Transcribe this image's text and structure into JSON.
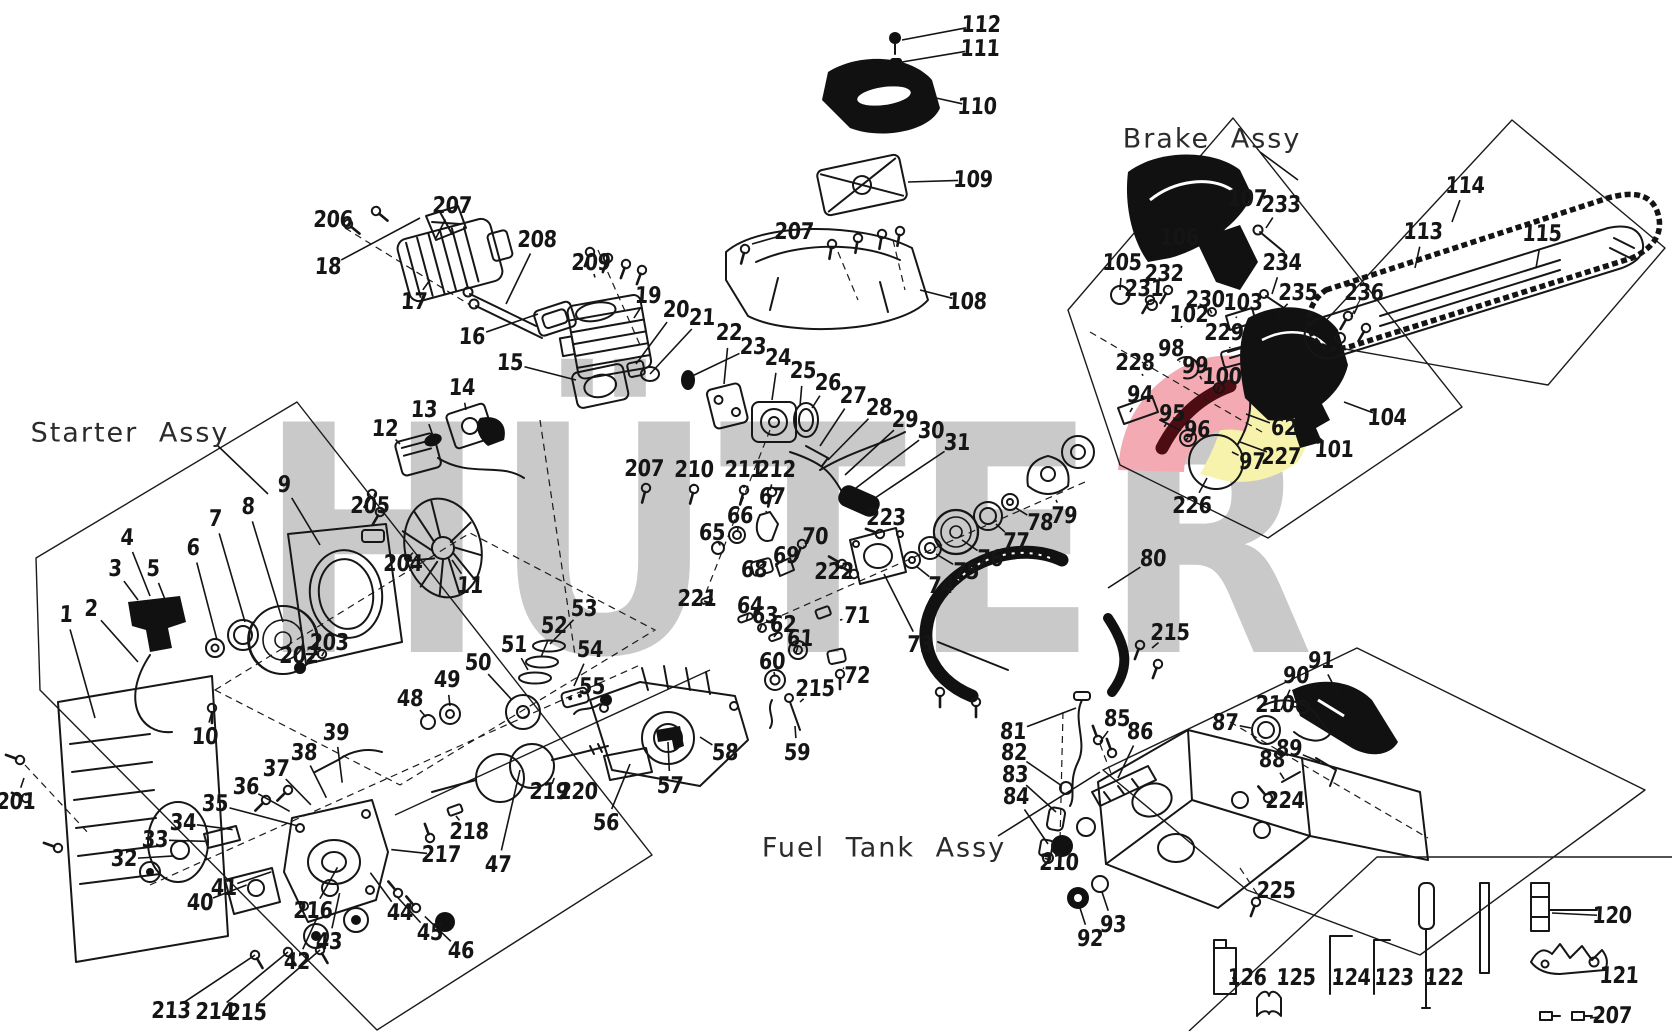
{
  "watermark": {
    "text": "HÜTER",
    "color": "#c9c9c9"
  },
  "highlight": {
    "pink": "#f3aab3",
    "yellow": "#f8f3ac",
    "dark_red": "#4d0b12"
  },
  "titles": [
    {
      "id": "starter",
      "text": "Starter Assy",
      "x": 130,
      "y": 433,
      "line": [
        218,
        446,
        268,
        494
      ]
    },
    {
      "id": "brake",
      "text": "Brake Assy",
      "x": 1212,
      "y": 139,
      "line": [
        1260,
        152,
        1298,
        180
      ]
    },
    {
      "id": "fuel",
      "text": "Fuel Tank Assy",
      "x": 884,
      "y": 848,
      "line": [
        998,
        836,
        1100,
        772
      ]
    }
  ],
  "groups": [
    {
      "name": "starter",
      "anchor": [
        250,
        655
      ],
      "items": [
        [
          "1",
          66,
          615,
          95,
          718
        ],
        [
          "2",
          91,
          609,
          138,
          662
        ],
        [
          "3",
          115,
          569,
          138,
          600
        ],
        [
          "4",
          127,
          538,
          150,
          596
        ],
        [
          "5",
          153,
          569,
          166,
          602
        ],
        [
          "6",
          193,
          548,
          217,
          640
        ],
        [
          "7",
          215,
          519,
          245,
          622
        ],
        [
          "8",
          248,
          507,
          283,
          622
        ],
        [
          "9",
          284,
          485,
          320,
          545
        ],
        [
          "10",
          205,
          737,
          212,
          712
        ],
        [
          "201",
          16,
          802,
          24,
          778
        ],
        [
          "202",
          299,
          656,
          300,
          666
        ],
        [
          "203",
          329,
          643,
          324,
          652
        ]
      ]
    },
    {
      "name": "flywheel",
      "anchor": [
        430,
        545
      ],
      "items": [
        [
          "11",
          470,
          586,
          452,
          560
        ],
        [
          "204",
          403,
          564,
          410,
          556
        ],
        [
          "205",
          370,
          506,
          374,
          496
        ],
        [
          "12",
          385,
          429,
          400,
          444
        ],
        [
          "13",
          424,
          410,
          433,
          436
        ],
        [
          "14",
          462,
          388,
          466,
          410
        ]
      ]
    },
    {
      "name": "muffler",
      "anchor": [
        450,
        262
      ],
      "items": [
        [
          "206",
          333,
          220,
          348,
          224
        ],
        [
          "207",
          452,
          206,
          436,
          238
        ],
        [
          "18",
          328,
          267,
          420,
          218
        ],
        [
          "17",
          414,
          302,
          430,
          280
        ],
        [
          "208",
          537,
          240,
          506,
          304
        ],
        [
          "16",
          472,
          337,
          538,
          314
        ]
      ]
    },
    {
      "name": "cylinder",
      "anchor": [
        608,
        340
      ],
      "items": [
        [
          "209",
          591,
          263,
          594,
          274
        ],
        [
          "19",
          648,
          296,
          634,
          318
        ],
        [
          "20",
          676,
          310,
          636,
          364
        ],
        [
          "21",
          702,
          318,
          650,
          374
        ],
        [
          "22",
          729,
          333,
          724,
          384
        ],
        [
          "23",
          753,
          347,
          688,
          378
        ],
        [
          "15",
          510,
          363,
          576,
          380
        ]
      ]
    },
    {
      "name": "carburetor",
      "anchor": [
        790,
        440
      ],
      "items": [
        [
          "24",
          778,
          358,
          772,
          400
        ],
        [
          "25",
          803,
          371,
          800,
          406
        ],
        [
          "26",
          828,
          383,
          812,
          408
        ],
        [
          "27",
          853,
          396,
          820,
          446
        ],
        [
          "28",
          879,
          408,
          828,
          460
        ],
        [
          "29",
          905,
          420,
          845,
          475
        ],
        [
          "30",
          931,
          431,
          856,
          488
        ],
        [
          "31",
          957,
          443,
          872,
          500
        ],
        [
          "207",
          644,
          469,
          646,
          484
        ],
        [
          "210",
          694,
          470,
          694,
          486
        ],
        [
          "211",
          744,
          470,
          744,
          488
        ],
        [
          "212",
          776,
          470,
          770,
          490
        ]
      ]
    },
    {
      "name": "airbox",
      "anchor": [
        880,
        230
      ],
      "items": [
        [
          "112",
          981,
          25,
          902,
          40
        ],
        [
          "111",
          980,
          49,
          902,
          62
        ],
        [
          "110",
          977,
          107,
          936,
          98
        ],
        [
          "109",
          973,
          180,
          908,
          182
        ],
        [
          "108",
          967,
          302,
          920,
          290
        ],
        [
          "207",
          794,
          232,
          752,
          244
        ]
      ]
    },
    {
      "name": "brake",
      "anchor": [
        1200,
        400
      ],
      "items": [
        [
          "105",
          1122,
          263,
          1120,
          290
        ],
        [
          "106",
          1179,
          238,
          1172,
          256
        ],
        [
          "107",
          1247,
          199,
          1222,
          232
        ],
        [
          "233",
          1281,
          205,
          1266,
          228
        ],
        [
          "231",
          1144,
          289,
          1150,
          300
        ],
        [
          "232",
          1164,
          274,
          1168,
          288
        ],
        [
          "230",
          1205,
          300,
          1210,
          310
        ],
        [
          "102",
          1189,
          315,
          1182,
          326
        ],
        [
          "103",
          1243,
          303,
          1236,
          318
        ],
        [
          "234",
          1282,
          263,
          1272,
          294
        ],
        [
          "235",
          1298,
          293,
          1276,
          316
        ],
        [
          "229",
          1224,
          333,
          1230,
          348
        ],
        [
          "98",
          1171,
          349,
          1180,
          362
        ],
        [
          "99",
          1195,
          366,
          1200,
          376
        ],
        [
          "100",
          1222,
          377,
          1219,
          386
        ],
        [
          "228",
          1135,
          363,
          1142,
          374
        ],
        [
          "94",
          1140,
          395,
          1130,
          412
        ],
        [
          "95",
          1172,
          414,
          1166,
          424
        ],
        [
          "96",
          1197,
          430,
          1188,
          438
        ],
        [
          "97",
          1252,
          462,
          1232,
          452
        ],
        [
          "62",
          1284,
          428,
          1246,
          414
        ],
        [
          "227",
          1281,
          457,
          1240,
          442
        ],
        [
          "101",
          1334,
          450,
          1312,
          432
        ],
        [
          "104",
          1387,
          418,
          1344,
          402
        ],
        [
          "226",
          1192,
          506,
          1207,
          478
        ]
      ]
    },
    {
      "name": "bar-chain",
      "anchor": [
        1480,
        280
      ],
      "items": [
        [
          "113",
          1423,
          232,
          1415,
          268
        ],
        [
          "114",
          1465,
          186,
          1452,
          222
        ],
        [
          "115",
          1542,
          234,
          1536,
          268
        ],
        [
          "236",
          1364,
          293,
          1354,
          314
        ]
      ]
    },
    {
      "name": "clutch",
      "anchor": [
        960,
        530
      ],
      "items": [
        [
          "223",
          886,
          518,
          882,
          530
        ],
        [
          "74",
          941,
          586,
          916,
          566
        ],
        [
          "75",
          966,
          572,
          936,
          554
        ],
        [
          "76",
          990,
          559,
          962,
          540
        ],
        [
          "77",
          1016,
          542,
          996,
          524
        ],
        [
          "78",
          1040,
          523,
          1016,
          508
        ],
        [
          "79",
          1064,
          516,
          1056,
          500
        ],
        [
          "73",
          920,
          645,
          884,
          574
        ],
        [
          "72",
          857,
          676,
          843,
          668
        ],
        [
          "71",
          857,
          616,
          840,
          620
        ],
        [
          "222",
          834,
          572,
          842,
          566
        ]
      ]
    },
    {
      "name": "chain-catcher",
      "anchor": [
        765,
        550
      ],
      "items": [
        [
          "67",
          772,
          497,
          766,
          512
        ],
        [
          "66",
          740,
          516,
          738,
          528
        ],
        [
          "65",
          712,
          533,
          718,
          542
        ],
        [
          "68",
          754,
          570,
          760,
          566
        ],
        [
          "69",
          786,
          556,
          780,
          562
        ],
        [
          "70",
          815,
          537,
          804,
          546
        ]
      ]
    },
    {
      "name": "bearings",
      "anchor": [
        775,
        655
      ],
      "items": [
        [
          "221",
          697,
          599,
          704,
          601
        ],
        [
          "64",
          750,
          606,
          748,
          614
        ],
        [
          "63",
          765,
          616,
          762,
          624
        ],
        [
          "62",
          783,
          625,
          777,
          633
        ],
        [
          "61",
          800,
          639,
          798,
          646
        ],
        [
          "60",
          772,
          662,
          774,
          672
        ],
        [
          "215",
          815,
          689,
          800,
          702
        ]
      ]
    },
    {
      "name": "piston-crank",
      "anchor": [
        520,
        710
      ],
      "items": [
        [
          "53",
          584,
          609,
          550,
          644
        ],
        [
          "52",
          554,
          626,
          541,
          657
        ],
        [
          "51",
          514,
          645,
          528,
          670
        ],
        [
          "50",
          478,
          663,
          512,
          700
        ],
        [
          "49",
          447,
          680,
          450,
          706
        ],
        [
          "48",
          410,
          699,
          426,
          717
        ],
        [
          "54",
          590,
          650,
          574,
          686
        ],
        [
          "55",
          592,
          687,
          602,
          696
        ]
      ]
    },
    {
      "name": "crankcase",
      "anchor": [
        620,
        760
      ],
      "items": [
        [
          "58",
          725,
          753,
          700,
          737
        ],
        [
          "59",
          797,
          753,
          795,
          726
        ],
        [
          "57",
          670,
          786,
          668,
          742
        ],
        [
          "56",
          606,
          823,
          630,
          764
        ],
        [
          "219",
          549,
          792,
          552,
          784
        ],
        [
          "220",
          578,
          792,
          565,
          786
        ]
      ]
    },
    {
      "name": "bottom-case",
      "anchor": [
        350,
        845
      ],
      "items": [
        [
          "39",
          336,
          733
        ],
        [
          "38",
          304,
          753
        ],
        [
          "37",
          276,
          769
        ],
        [
          "36",
          246,
          787
        ],
        [
          "35",
          215,
          804,
          298,
          826
        ],
        [
          "34",
          183,
          823
        ],
        [
          "33",
          155,
          840
        ],
        [
          "32",
          124,
          859
        ],
        [
          "40",
          200,
          903
        ],
        [
          "41",
          224,
          888
        ],
        [
          "42",
          297,
          962
        ],
        [
          "43",
          329,
          942
        ],
        [
          "44",
          400,
          913
        ],
        [
          "45",
          430,
          933
        ],
        [
          "46",
          461,
          951
        ],
        [
          "47",
          498,
          865,
          520,
          770
        ],
        [
          "213",
          171,
          1011,
          255,
          955
        ],
        [
          "214",
          215,
          1012,
          288,
          952
        ],
        [
          "215",
          247,
          1013,
          320,
          950
        ],
        [
          "216",
          313,
          911
        ],
        [
          "217",
          441,
          855
        ],
        [
          "218",
          469,
          832,
          456,
          816
        ]
      ]
    },
    {
      "name": "front-handle",
      "anchor": [
        1050,
        600
      ],
      "items": [
        [
          "80",
          1153,
          559,
          1108,
          588
        ],
        [
          "215",
          1170,
          633,
          1152,
          648
        ]
      ]
    },
    {
      "name": "fuel-tank",
      "anchor": [
        1250,
        800
      ],
      "items": [
        [
          "81",
          1013,
          732,
          1076,
          708
        ],
        [
          "82",
          1014,
          753,
          1062,
          786
        ],
        [
          "83",
          1015,
          775,
          1056,
          812
        ],
        [
          "84",
          1016,
          797,
          1048,
          844
        ],
        [
          "85",
          1117,
          719,
          1100,
          742
        ],
        [
          "86",
          1140,
          732,
          1118,
          778
        ],
        [
          "210",
          1059,
          863,
          1050,
          860
        ],
        [
          "92",
          1090,
          939,
          1080,
          908
        ],
        [
          "93",
          1113,
          925,
          1102,
          892
        ],
        [
          "225",
          1276,
          891,
          1257,
          898
        ]
      ]
    },
    {
      "name": "rear-handle",
      "anchor": [
        1330,
        700
      ],
      "items": [
        [
          "87",
          1225,
          723,
          1251,
          728
        ],
        [
          "210",
          1275,
          705,
          1297,
          707
        ],
        [
          "88",
          1272,
          760,
          1284,
          779
        ],
        [
          "89",
          1289,
          749,
          1320,
          762
        ],
        [
          "224",
          1285,
          801,
          1271,
          797
        ],
        [
          "90",
          1296,
          676,
          1281,
          710
        ],
        [
          "91",
          1321,
          661,
          1338,
          694
        ]
      ]
    },
    {
      "name": "tools",
      "anchor": [
        1420,
        950
      ],
      "items": [
        [
          "126",
          1247,
          978,
          1236,
          978
        ],
        [
          "125",
          1296,
          978,
          1283,
          978
        ],
        [
          "124",
          1351,
          978,
          1338,
          978
        ],
        [
          "123",
          1394,
          978,
          1380,
          978
        ],
        [
          "122",
          1444,
          978,
          1430,
          978
        ],
        [
          "120",
          1612,
          916,
          1552,
          913
        ],
        [
          "121",
          1619,
          976,
          1605,
          968
        ],
        [
          "207",
          1612,
          1016,
          1590,
          1018
        ]
      ]
    }
  ]
}
